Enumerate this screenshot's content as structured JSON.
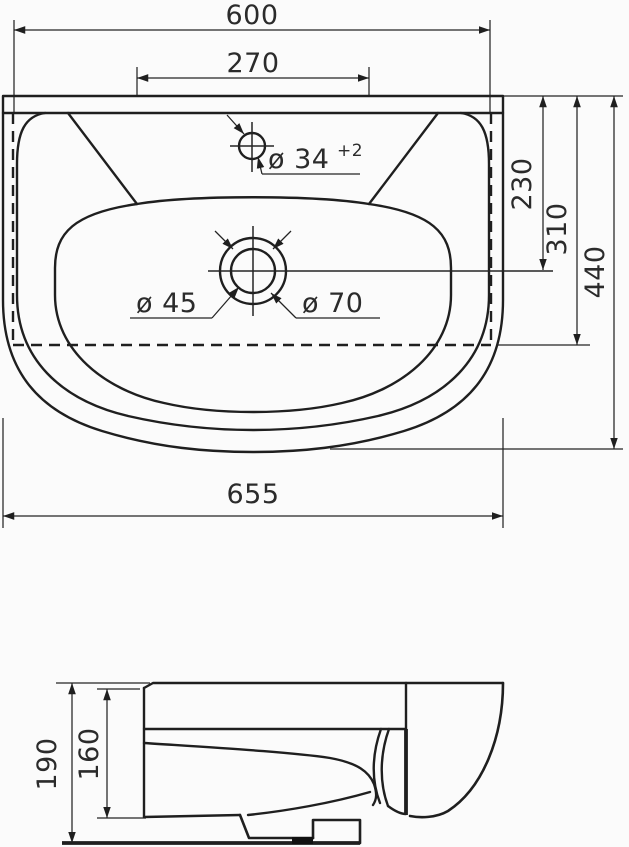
{
  "drawing": {
    "type": "washbasin technical drawing",
    "top_view": {
      "dim_width_inner": "600",
      "dim_faucet_span": "270",
      "label_faucet_hole": "ø 34",
      "label_faucet_tolerance": "+2",
      "dim_drain_depth": "230",
      "dim_ledge_depth": "310",
      "dim_overall_depth": "440",
      "label_drain_inner": "ø 45",
      "label_drain_outer": "ø 70",
      "dim_width_overall": "655"
    },
    "side_view": {
      "dim_total_height": "190",
      "dim_body_height": "160"
    },
    "colors": {
      "line": "#1f1f1f",
      "text": "#2b2b2b",
      "background": "#fbfbfb"
    }
  }
}
